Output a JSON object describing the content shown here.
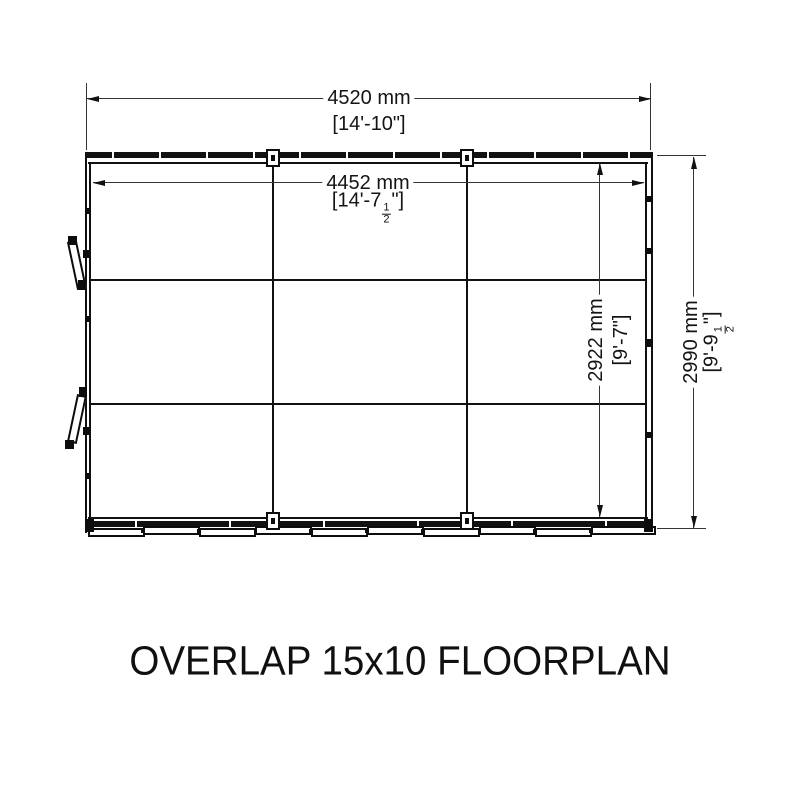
{
  "title": "OVERLAP 15x10 FLOORPLAN",
  "dimensions": {
    "top_outer": {
      "metric": "4520 mm",
      "imperial": "[14'-10\"]"
    },
    "top_inner": {
      "metric": "4452 mm",
      "imperial_pre": "[14'-7",
      "frac_num": "1",
      "frac_den": "2",
      "imperial_post": "\"]"
    },
    "right_inner": {
      "metric": "2922 mm",
      "imperial": "[9'-7\"]"
    },
    "right_outer": {
      "metric": "2990 mm",
      "imperial_pre": "[9'-9",
      "frac_num": "1",
      "frac_den": "2",
      "imperial_post": "\"]"
    }
  },
  "colors": {
    "line": "#111111",
    "background": "#ffffff"
  }
}
